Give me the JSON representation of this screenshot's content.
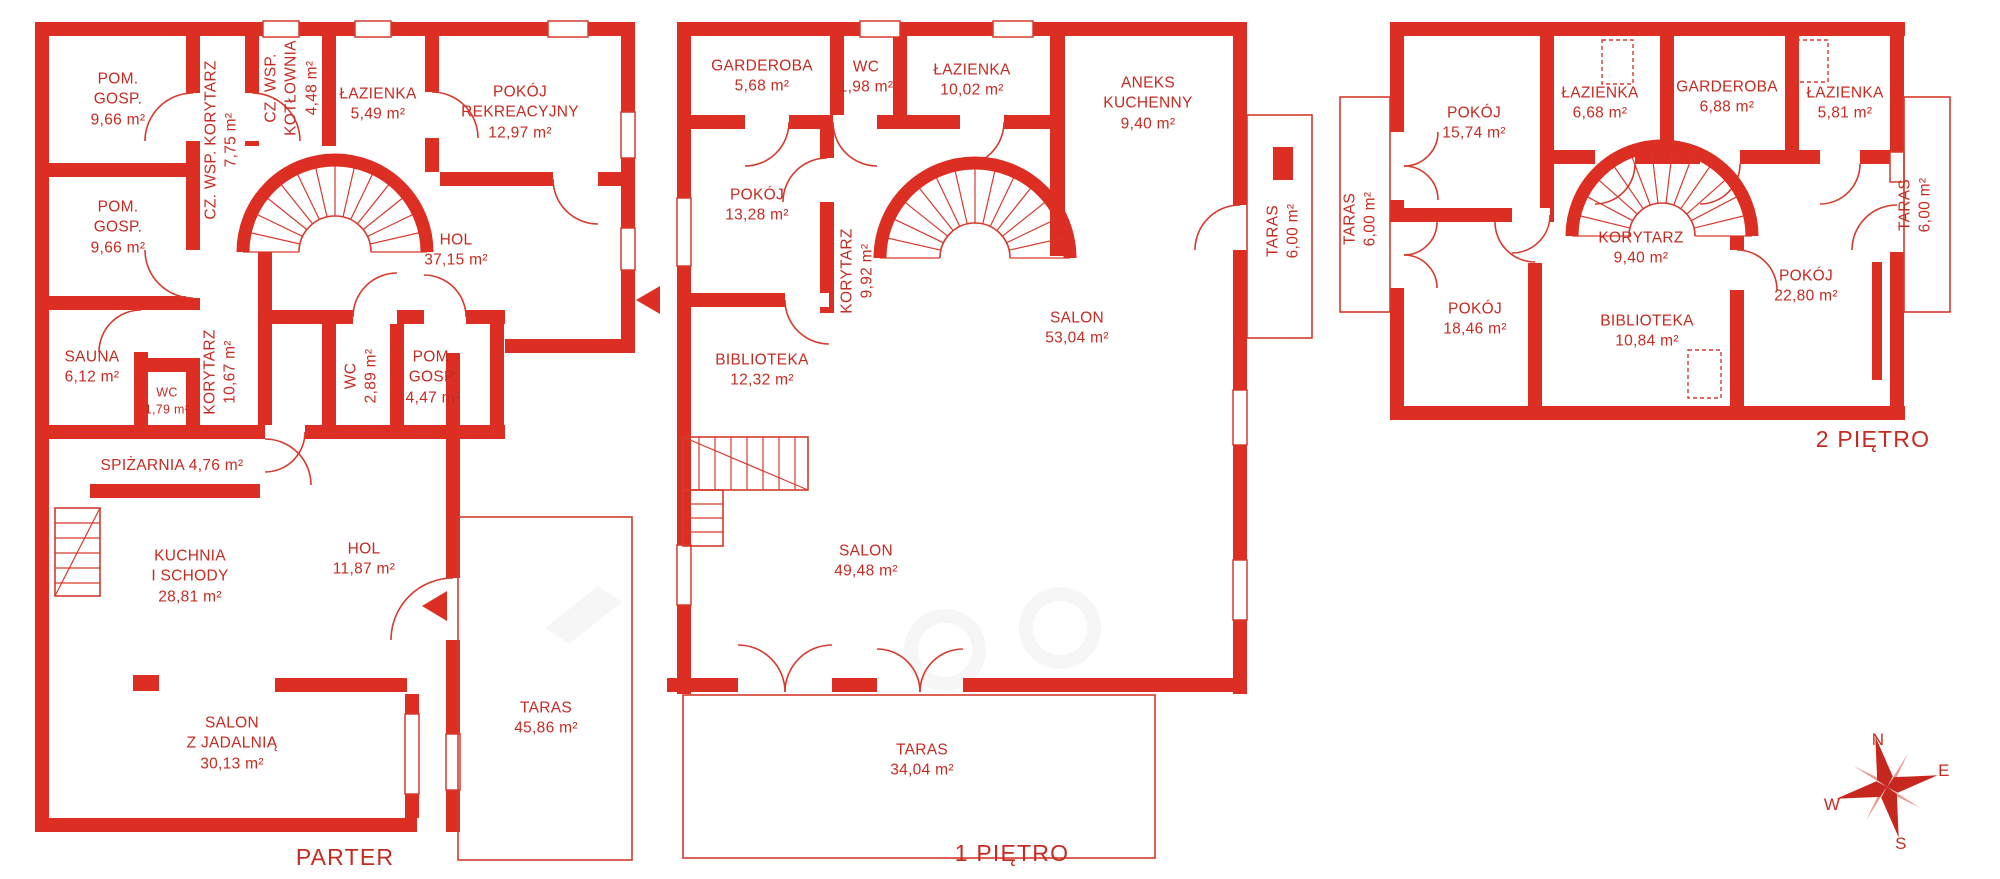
{
  "colors": {
    "wall": "#dc2e22",
    "text": "#c62b22",
    "secondary_star": "#ea9a90"
  },
  "floors": [
    {
      "id": "parter",
      "title": {
        "text": "PARTER",
        "x": 345,
        "y": 857
      },
      "rooms": [
        {
          "text": "POM.\nGOSP.\n9,66 m²",
          "x": 118,
          "y": 100
        },
        {
          "text": "CZ. WSP. KORYTARZ\n7,75 m²",
          "x": 222,
          "y": 140,
          "rot": -90
        },
        {
          "text": "CZ. WSP.\nKOTŁOWNIA\n4,48 m²",
          "x": 292,
          "y": 88,
          "rot": -90
        },
        {
          "text": "ŁAZIENKA\n5,49 m²",
          "x": 378,
          "y": 105
        },
        {
          "text": "POKÓJ\nREKREACYJNY\n12,97 m²",
          "x": 520,
          "y": 113
        },
        {
          "text": "HOL\n37,15 m²",
          "x": 456,
          "y": 251
        },
        {
          "text": "POM.\nGOSP.\n9,66 m²",
          "x": 118,
          "y": 228
        },
        {
          "text": "SAUNA\n6,12 m²",
          "x": 92,
          "y": 368
        },
        {
          "text": "WC\n1,79 m²",
          "x": 167,
          "y": 401,
          "fs": 12.5
        },
        {
          "text": "KORYTARZ\n10,67 m²",
          "x": 221,
          "y": 372,
          "rot": -90
        },
        {
          "text": "WC\n2,89 m²",
          "x": 362,
          "y": 376,
          "rot": -90
        },
        {
          "text": "POM.\nGOSP.\n4,47 m²",
          "x": 433,
          "y": 378
        },
        {
          "text": "SPIŻARNIA 4,76 m²",
          "x": 172,
          "y": 466
        },
        {
          "text": "KUCHNIA\nI SCHODY\n28,81 m²",
          "x": 190,
          "y": 577
        },
        {
          "text": "HOL\n11,87 m²",
          "x": 364,
          "y": 560
        },
        {
          "text": "SALON\nZ JADALNIĄ\n30,13 m²",
          "x": 232,
          "y": 744
        },
        {
          "text": "TARAS\n45,86 m²",
          "x": 546,
          "y": 719
        }
      ]
    },
    {
      "id": "pietro-1",
      "title": {
        "text": "1 PIĘTRO",
        "x": 1012,
        "y": 853
      },
      "rooms": [
        {
          "text": "GARDEROBA\n5,68 m²",
          "x": 762,
          "y": 77
        },
        {
          "text": "WC\n1,98 m²",
          "x": 866,
          "y": 78
        },
        {
          "text": "ŁAZIENKA\n10,02 m²",
          "x": 972,
          "y": 81
        },
        {
          "text": "ANEKS\nKUCHENNY\n9,40 m²",
          "x": 1148,
          "y": 104
        },
        {
          "text": "POKÓJ\n13,28 m²",
          "x": 757,
          "y": 206
        },
        {
          "text": "KORYTARZ\n9,92 m²",
          "x": 858,
          "y": 271,
          "rot": -90
        },
        {
          "text": "TARAS\n6,00 m²",
          "x": 1284,
          "y": 231,
          "rot": -90
        },
        {
          "text": "SALON\n53,04 m²",
          "x": 1077,
          "y": 329
        },
        {
          "text": "BIBLIOTEKA\n12,32 m²",
          "x": 762,
          "y": 371
        },
        {
          "text": "SALON\n49,48 m²",
          "x": 866,
          "y": 562
        },
        {
          "text": "TARAS\n34,04 m²",
          "x": 922,
          "y": 761
        }
      ]
    },
    {
      "id": "pietro-2",
      "title": {
        "text": "2 PIĘTRO",
        "x": 1873,
        "y": 439
      },
      "rooms": [
        {
          "text": "POKÓJ\n15,74 m²",
          "x": 1474,
          "y": 124
        },
        {
          "text": "ŁAZIENKA\n6,68 m²",
          "x": 1600,
          "y": 104
        },
        {
          "text": "GARDEROBA\n6,88 m²",
          "x": 1727,
          "y": 98
        },
        {
          "text": "ŁAZIENKA\n5,81 m²",
          "x": 1845,
          "y": 104
        },
        {
          "text": "TARAS\n6,00 m²",
          "x": 1361,
          "y": 219,
          "rot": -90
        },
        {
          "text": "KORYTARZ\n9,40 m²",
          "x": 1641,
          "y": 249
        },
        {
          "text": "TARAS\n6,00 m²",
          "x": 1916,
          "y": 205,
          "rot": -90
        },
        {
          "text": "POKÓJ\n18,46 m²",
          "x": 1475,
          "y": 320
        },
        {
          "text": "BIBLIOTEKA\n10,84 m²",
          "x": 1647,
          "y": 332
        },
        {
          "text": "POKÓJ\n22,80 m²",
          "x": 1806,
          "y": 287
        }
      ]
    }
  ],
  "compass": {
    "letters": [
      {
        "t": "N",
        "x": 1878,
        "y": 740
      },
      {
        "t": "E",
        "x": 1944,
        "y": 771
      },
      {
        "t": "W",
        "x": 1832,
        "y": 805
      },
      {
        "t": "S",
        "x": 1901,
        "y": 844
      }
    ]
  }
}
